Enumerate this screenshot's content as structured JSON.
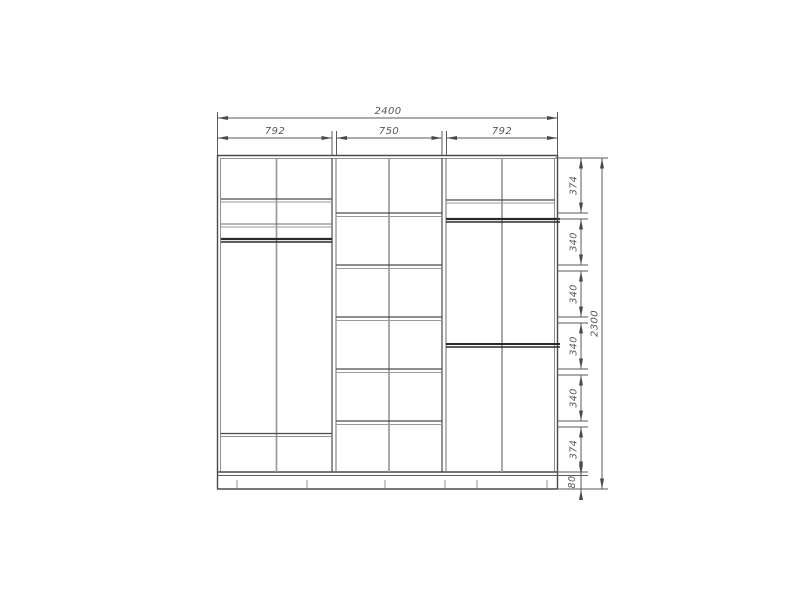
{
  "drawing": {
    "kind": "wardrobe front elevation technical drawing",
    "width_dims": {
      "total": "2400",
      "sections": [
        "792",
        "750",
        "792"
      ]
    },
    "height_dims": {
      "total": "2300",
      "chain": [
        "374",
        "340",
        "340",
        "340",
        "340",
        "374",
        "80"
      ]
    },
    "colors": {
      "panel_line": "#4a4a4a",
      "thin_line": "#999999",
      "rod_line": "#2a2a2a",
      "dimension_line": "#5a5a5a",
      "dimension_text": "#565656",
      "background": "#ffffff"
    }
  }
}
